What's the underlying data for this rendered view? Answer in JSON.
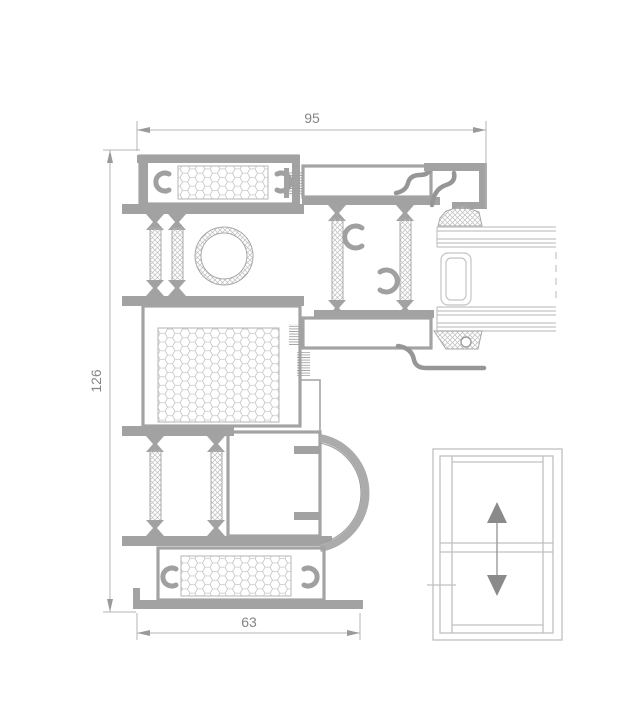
{
  "drawing": {
    "dimension_top": "95",
    "dimension_left": "126",
    "dimension_bottom": "63",
    "colors": {
      "background": "#ffffff",
      "profile": "#a2a2a2",
      "hatch_line": "#bdbdbd",
      "honeycomb_line": "#c5c5c5",
      "dimension_line": "#b6b6b6",
      "dimension_text": "#858585",
      "arrow": "#9a9a9a",
      "icon_outline": "#c0c0c0",
      "icon_arrow": "#8a8a8a"
    },
    "icons": {
      "window": "vertical-sliding-window-icon",
      "arrow_up": "arrow-up-icon",
      "arrow_down": "arrow-down-icon"
    }
  }
}
